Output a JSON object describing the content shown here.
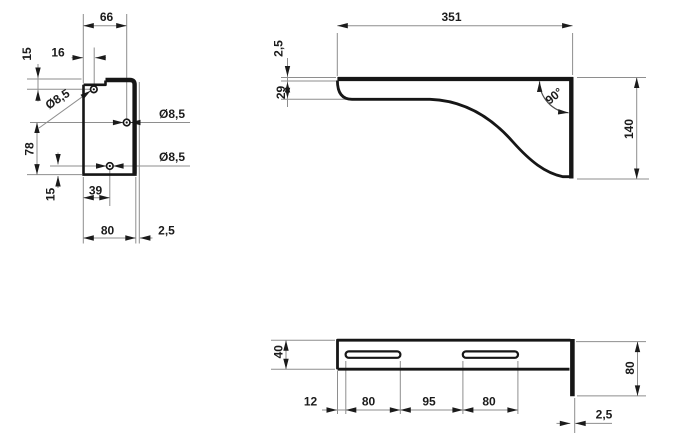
{
  "drawing": {
    "kind": "technical-drawing-bracket",
    "colors": {
      "outline": "#161616",
      "dimension_lines": "#8e8e8e",
      "text": "#1b1b1b",
      "background": "#ffffff"
    },
    "views": {
      "front": {
        "dims": {
          "top_width": "66",
          "hole_x_offset": "16",
          "hole_y_offset_top": "15",
          "hole_dia_top": "Ø8,5",
          "hole_dia_mid": "Ø8,5",
          "hole_dia_bottom": "Ø8,5",
          "holes_span": "78",
          "bottom_hole_x": "39",
          "hole_y_offset_bottom": "15",
          "plate_width": "80",
          "plate_thickness": "2,5"
        }
      },
      "side": {
        "dims": {
          "length": "351",
          "flange_thickness": "2,5",
          "lip_height": "29",
          "corner_angle": "90°",
          "height": "140"
        }
      },
      "top": {
        "dims": {
          "flange_depth": "40",
          "slot_offset": "12",
          "slot1_length": "80",
          "slot_gap": "95",
          "slot2_length": "80",
          "back_plate_width": "80",
          "plate_thickness": "2,5"
        }
      }
    }
  }
}
